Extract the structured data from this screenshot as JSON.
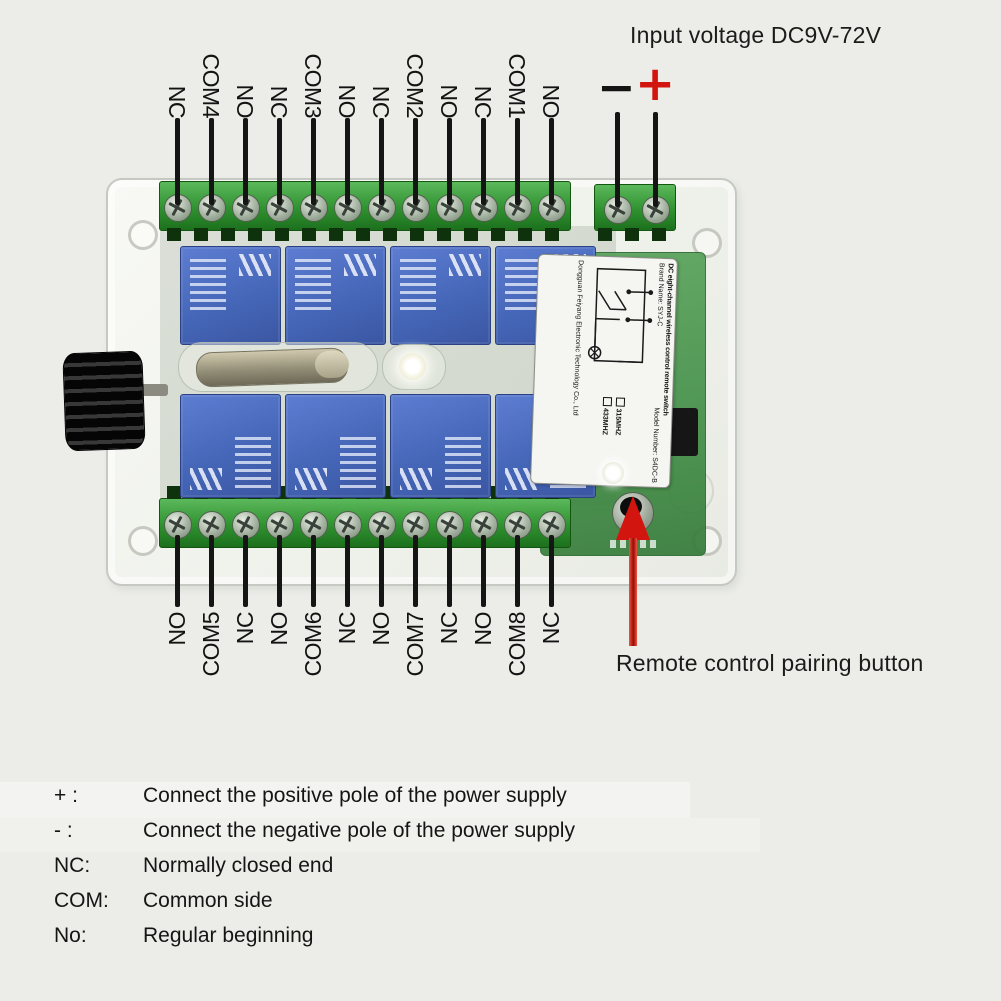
{
  "title": "Input voltage DC9V-72V",
  "board": {
    "top_labels": [
      "NC",
      "COM4",
      "NO",
      "NC",
      "COM3",
      "NO",
      "NC",
      "COM2",
      "NO",
      "NC",
      "COM1",
      "NO"
    ],
    "bottom_labels": [
      "NO",
      "COM5",
      "NC",
      "NO",
      "COM6",
      "NC",
      "NO",
      "COM7",
      "NC",
      "NO",
      "COM8",
      "NC"
    ],
    "power_labels": {
      "minus": "−",
      "plus": "+"
    },
    "sticker": {
      "title": "DC eight-channel wireless control remote switch",
      "brand_line": "Brand Name: SYJ-C",
      "model_line": "Model Number: S4DC-B",
      "freq_options": [
        "315MHZ",
        "433MHZ"
      ],
      "company": "Dongguan Feiyang Electronic Technology Co., Ltd"
    }
  },
  "annotations": {
    "pairing_button": "Remote control pairing button"
  },
  "legend": {
    "rows": [
      {
        "term": "+ :",
        "desc": "Connect the positive pole of the power supply"
      },
      {
        "term": "- :",
        "desc": "Connect the negative pole of the power supply"
      },
      {
        "term": "NC:",
        "desc": "Normally closed end"
      },
      {
        "term": "COM:",
        "desc": "Common side"
      },
      {
        "term": "No:",
        "desc": "Regular beginning"
      }
    ]
  },
  "colors": {
    "background": "#ecede8",
    "terminal_green": "#3f9d3f",
    "relay_blue": "#4d6fc0",
    "pcb_green": "#4e9151",
    "accent_red": "#d2150f",
    "text_black": "#161616",
    "case_white": "#f4f5f1"
  }
}
